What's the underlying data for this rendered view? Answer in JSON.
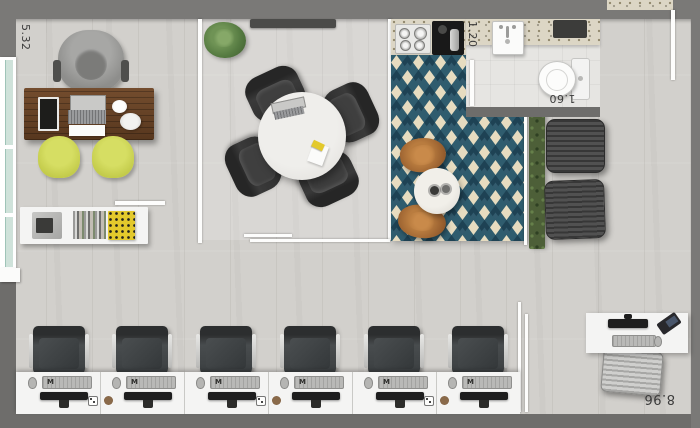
{
  "plan": {
    "title": "office-floor-plan",
    "labels": {
      "office_height": "5.32",
      "bathroom_width": "1.20",
      "bathroom_length": "1.60",
      "plan_width": "8.96"
    },
    "workstations": {
      "keyboard_logo": "M",
      "count": 6
    },
    "colors": {
      "wall": "#7a7977",
      "wall_dark": "#6e6d6b",
      "floor": "#d2d0cc",
      "bath_floor": "#e6e5e2",
      "terrazzo_counter": "#dcd6c5",
      "rug_teal": "#2f5c6e",
      "rug_navy": "#1e4254",
      "rug_cream": "#e7dcc0",
      "desk_wood": "#6a452a",
      "lounge_wood": "#9a6130",
      "guest_chair_yellow": "#c9d153",
      "hedge_green": "#4d5f38",
      "meeting_chair": "#2e2e2e",
      "furniture_white": "#f4f4f3",
      "label_text": "#3b3b3b"
    }
  }
}
